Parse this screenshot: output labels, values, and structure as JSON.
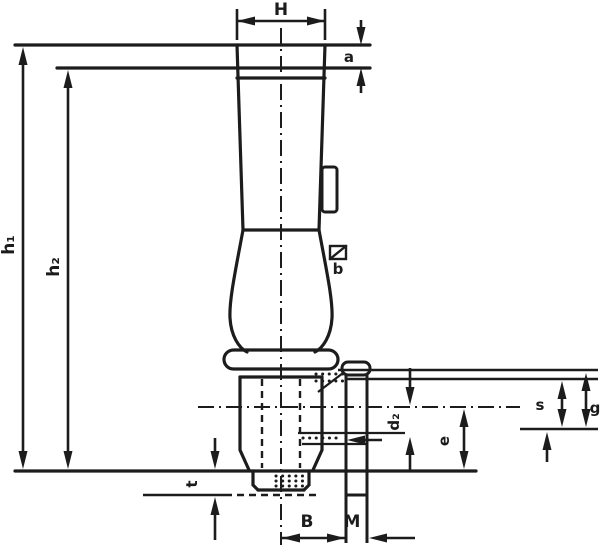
{
  "drawing": {
    "type": "technical-dimension-drawing",
    "line_color": "#1c1c1c",
    "background": "#ffffff",
    "labels": {
      "head_width": "H",
      "cap_height": "a",
      "height_outer": "h₁",
      "height_inner": "h₂",
      "clip": "b",
      "boss_dia": "d₂",
      "center_to_base": "e",
      "right_inner": "s",
      "right_outer": "g",
      "stub_height": "t",
      "base_width": "B",
      "thread_width": "M"
    }
  }
}
